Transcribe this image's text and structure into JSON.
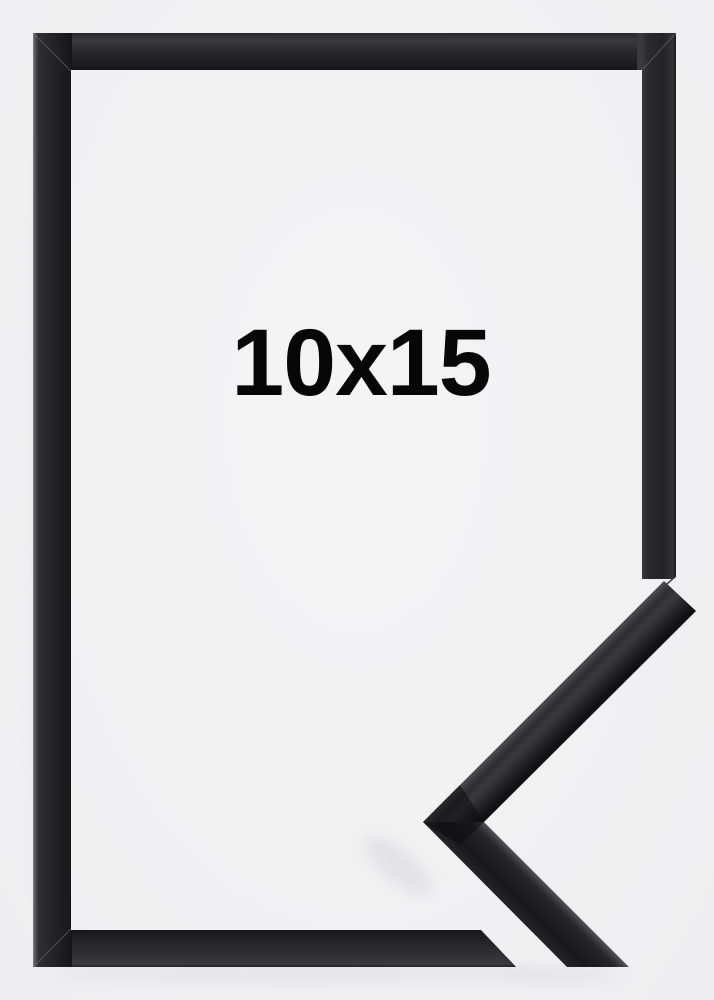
{
  "product": {
    "size_label": "10x15"
  },
  "theme": {
    "background": "#f1f1f2",
    "frame-dark": "#222224",
    "frame-mid": "#2e2e30",
    "frame-highlight": "#4b4b4e",
    "label-color": "#070707",
    "shadow": "#dcdcdf"
  }
}
